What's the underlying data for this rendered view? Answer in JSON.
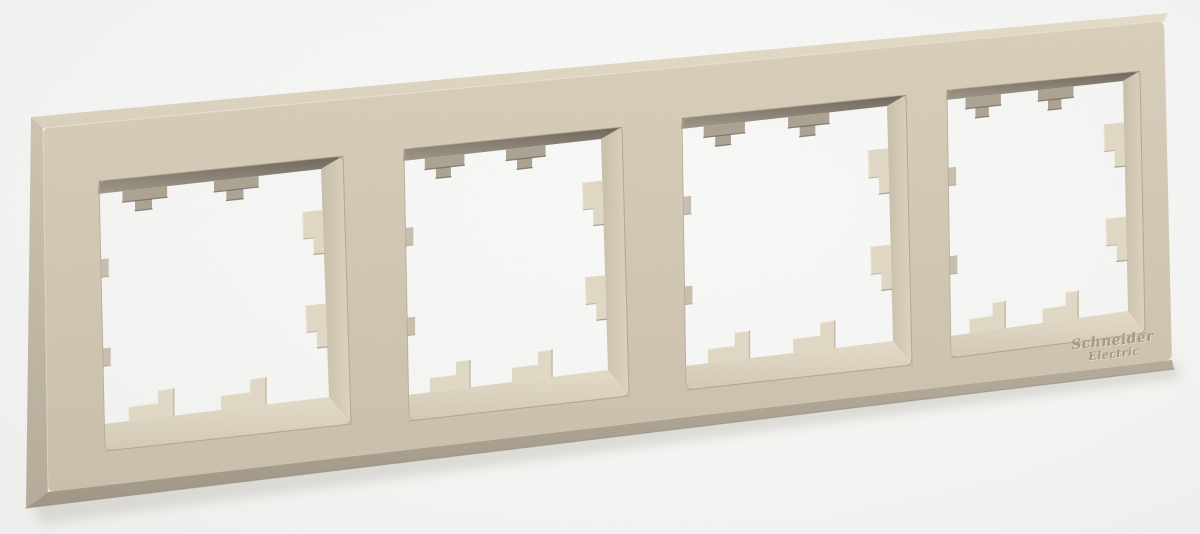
{
  "scene": {
    "description": "Product photo of a beige four-gang electrical wall switch frame, viewed at a slight angle on a white background",
    "background": "#f5f5f3"
  },
  "brand": {
    "line1": "Schneider",
    "line2": "Electric"
  },
  "frame": {
    "gang_count": 4,
    "finish": "sand beige"
  },
  "colors": {
    "face_top": "#d8ceba",
    "face_bottom": "#c9bfab",
    "side_top": "#cdc3b0",
    "side_bottom": "#b5ab99",
    "top_face_light": "#e4dbc8",
    "top_face_dark": "#d9cfbc",
    "foot_top": "#b4ab9a",
    "foot_bottom": "#9f9685",
    "wall_top_dark": "#6e6659",
    "wall_top_light": "#a0978a",
    "wall_bottom_light": "#e3dbc7",
    "wall_bottom_dark": "#d2c9b5",
    "wall_right_back": "#c8beaa",
    "wall_right_front": "#ddd4c0",
    "tab_top": "#aba292",
    "tab_light": "#e0d8c4",
    "tab_side": "#beb5a2",
    "edge_dark": "#6b6356",
    "edge_mid": "#9d9382",
    "cut_edge": "#b2a895",
    "ridge_light": "#e8e0cd",
    "nub": "#c8bead",
    "logo": "#a39884",
    "logo_highlight": "#eae1cd",
    "shadow": "#c4c2bb"
  }
}
